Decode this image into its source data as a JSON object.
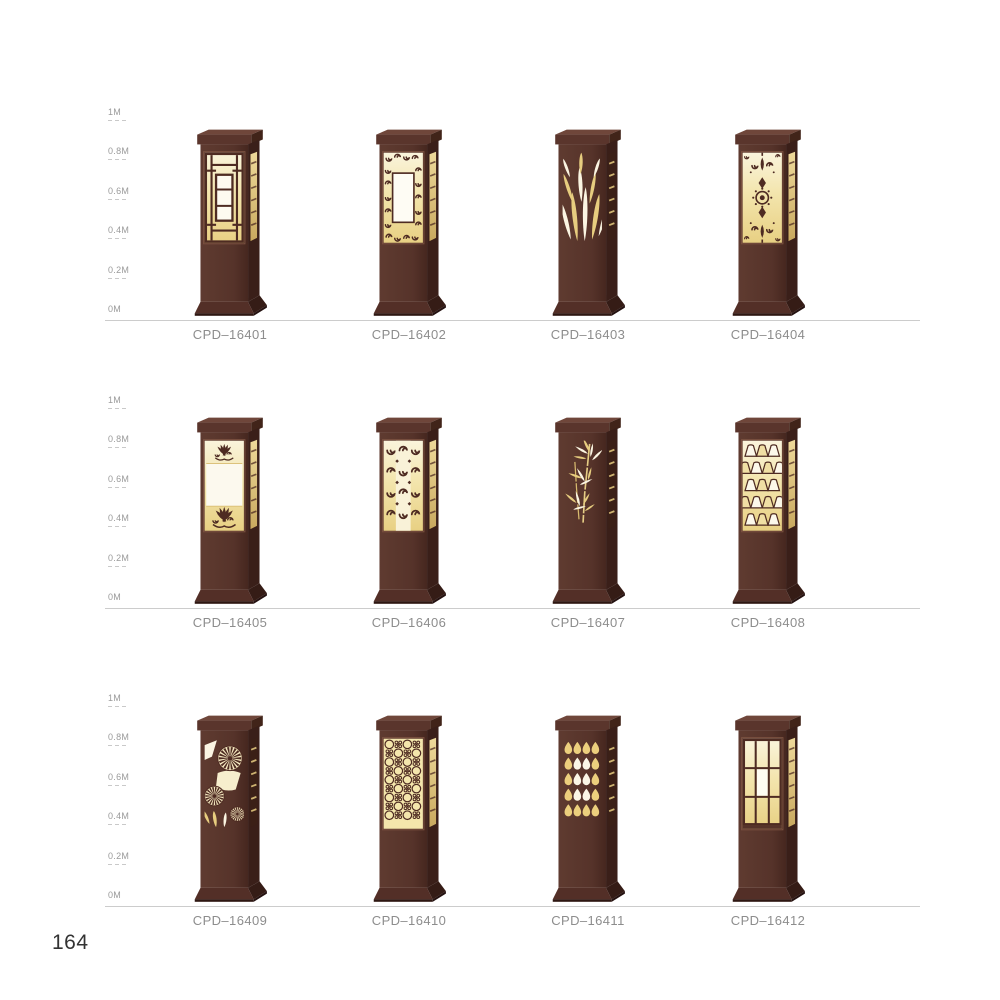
{
  "page": {
    "number": "164"
  },
  "scale_labels": [
    "1M",
    "0.8M",
    "0.6M",
    "0.4M",
    "0.2M",
    "0M"
  ],
  "rows": [
    {
      "products": [
        {
          "model": "CPD–16401",
          "pattern": "chinese-lattice-window"
        },
        {
          "model": "CPD–16402",
          "pattern": "scroll-border"
        },
        {
          "model": "CPD–16403",
          "pattern": "willow-branches"
        },
        {
          "model": "CPD–16404",
          "pattern": "baroque-medallion"
        }
      ]
    },
    {
      "products": [
        {
          "model": "CPD–16405",
          "pattern": "lotus-flowers"
        },
        {
          "model": "CPD–16406",
          "pattern": "double-scrolls"
        },
        {
          "model": "CPD–16407",
          "pattern": "bamboo-leaves"
        },
        {
          "model": "CPD–16408",
          "pattern": "mountain-shades"
        }
      ]
    },
    {
      "products": [
        {
          "model": "CPD–16409",
          "pattern": "chrysanthemum-fans"
        },
        {
          "model": "CPD–16410",
          "pattern": "ring-lattice"
        },
        {
          "model": "CPD–16411",
          "pattern": "teardrop-grid"
        },
        {
          "model": "CPD–16412",
          "pattern": "shoji-grid"
        }
      ]
    }
  ],
  "colors": {
    "body": "#56332a",
    "body_shadow": "#3a1f19",
    "motif_brown": "#4e2b22",
    "cap_top": "#6f463a",
    "glow_light": "#faf4dc",
    "glow": "#f3e5ad",
    "glow_deep": "#e8d083",
    "panel_white": "#fcf9ee",
    "label_text": "#8d8d8d",
    "scale_text": "#9a9a9a",
    "baseline": "#cccccc",
    "page_number_text": "#333333"
  }
}
